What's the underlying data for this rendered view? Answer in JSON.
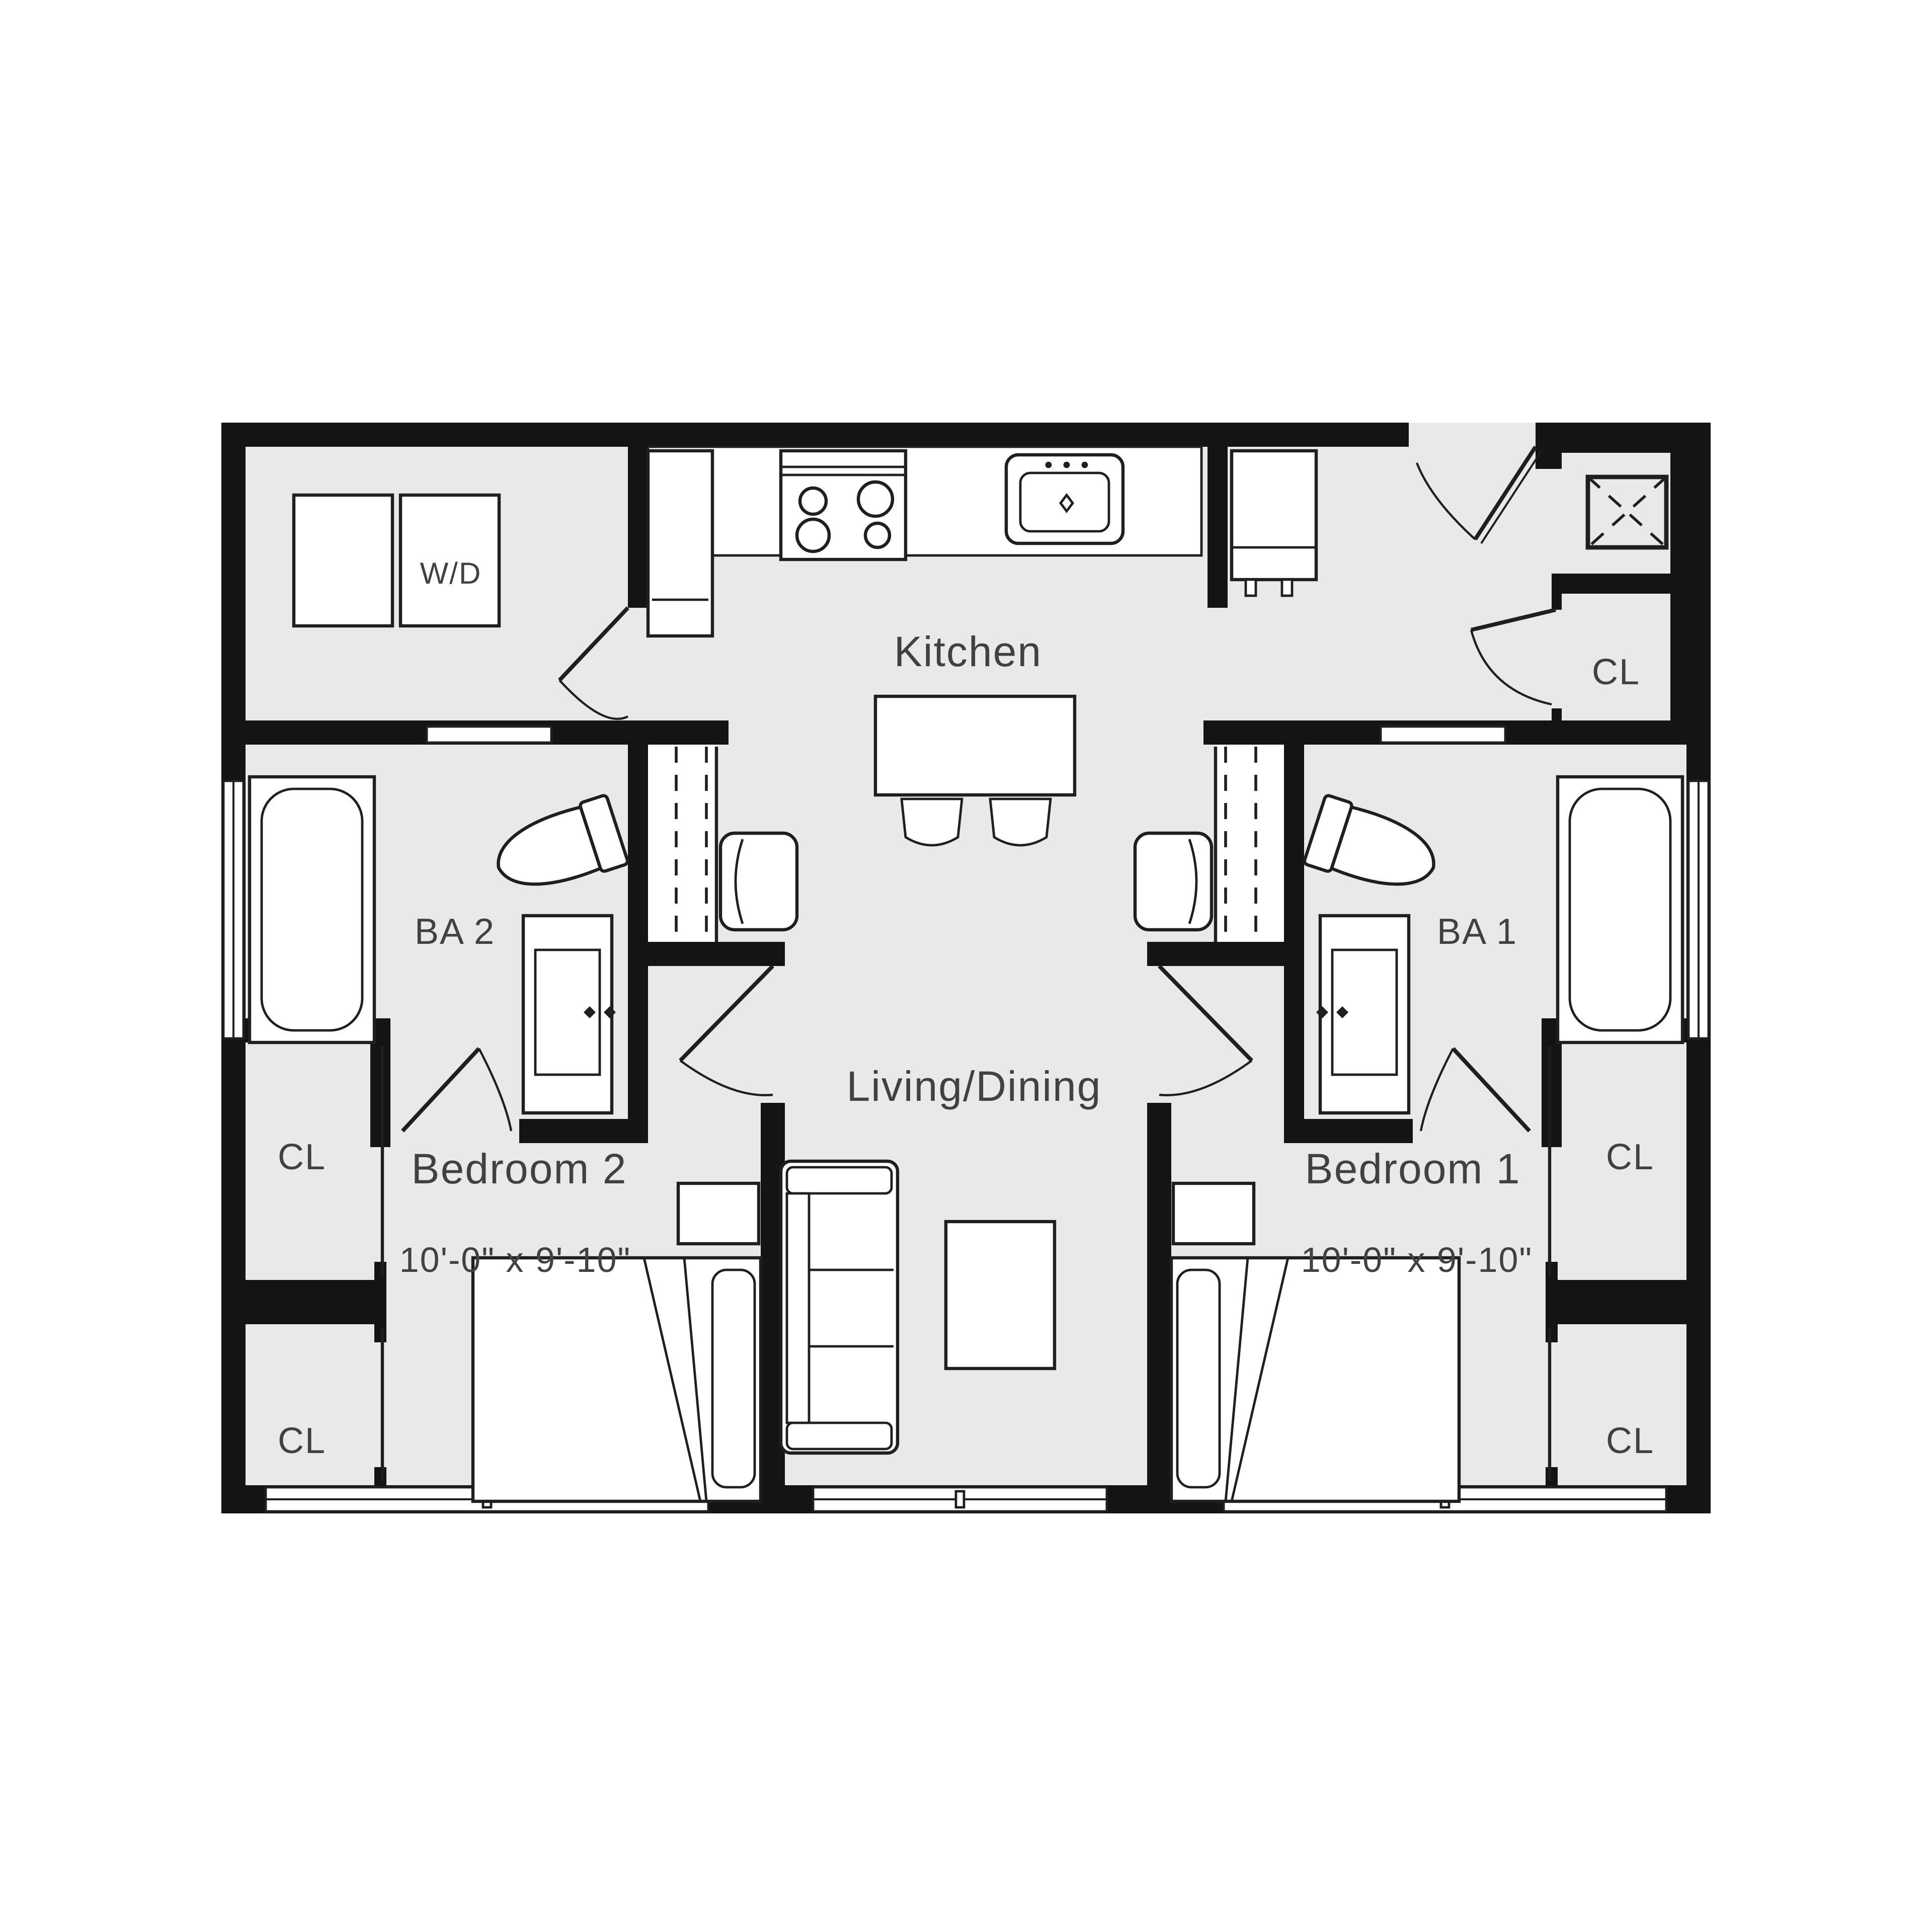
{
  "floor_plan": {
    "kind": "2 bedroom / 2 bath apartment unit plan",
    "labels": {
      "kitchen": "Kitchen",
      "living_dining": "Living/Dining",
      "bedroom_2": "Bedroom 2",
      "bedroom_2_dims": "10'-0\" x 9'-10\"",
      "bedroom_1": "Bedroom 1",
      "bedroom_1_dims": "10'-0\" x 9'-10\"",
      "bath_2": "BA 2",
      "bath_1": "BA 1",
      "washer_dryer": "W/D",
      "closet_entry": "CL",
      "closet_left_upper": "CL",
      "closet_left_lower": "CL",
      "closet_right_upper": "CL",
      "closet_right_lower": "CL"
    },
    "colors": {
      "walls": "#141414",
      "floor": "#e9e9ea",
      "fixtures": "#ffffff",
      "lines": "#1f1f1f",
      "text": "#414141",
      "background": "#ffffff"
    },
    "fixtures_visible": [
      "bathtub x2",
      "toilet x2",
      "vanity-sink x2",
      "washer-dryer pair",
      "range 4-burner",
      "kitchen-sink",
      "refrigerator",
      "tall-cabinet",
      "kitchen-island",
      "bar-stool x2",
      "armchair x2",
      "sofa",
      "coffee-table",
      "bed x2",
      "nightstand x2",
      "sliding-door closet x2",
      "hatched shaft",
      "entry door",
      "interior doors",
      "windows x5"
    ]
  }
}
